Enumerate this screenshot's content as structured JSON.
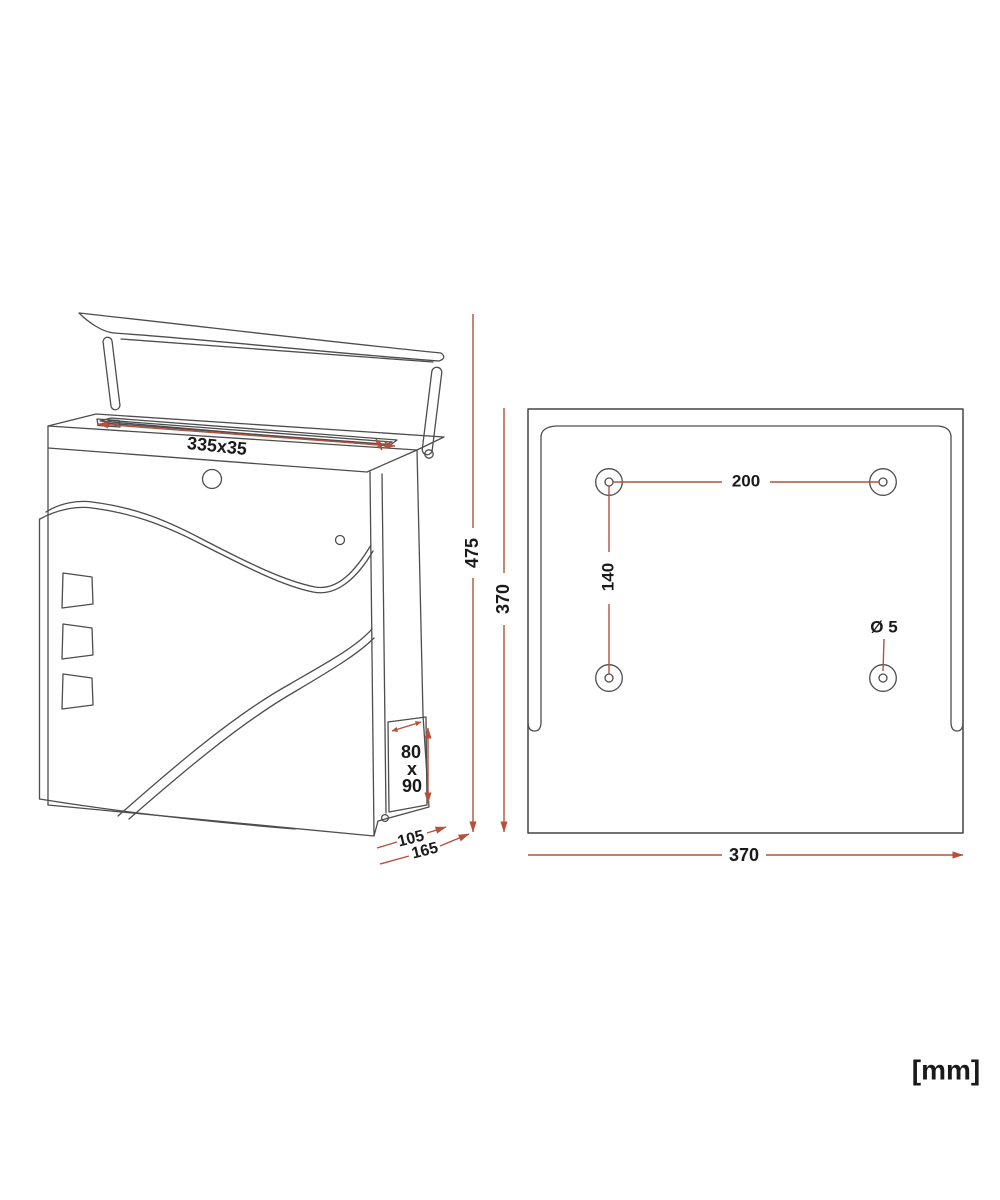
{
  "diagram": {
    "units": "[mm]",
    "colors": {
      "line": "#4d4d4d",
      "dimension_red": "#b5503c",
      "text": "#1a1a1a",
      "background": "#ffffff"
    },
    "perspective_view": {
      "slot_size": "335x35",
      "door_width": "80",
      "door_separator": "x",
      "door_height": "90",
      "depth_front": "105",
      "depth_total": "165",
      "overall_height": "475",
      "body_height": "370"
    },
    "back_view": {
      "hole_spacing_horizontal": "200",
      "hole_spacing_vertical": "140",
      "hole_diameter": "Ø 5",
      "plate_width": "370"
    }
  }
}
